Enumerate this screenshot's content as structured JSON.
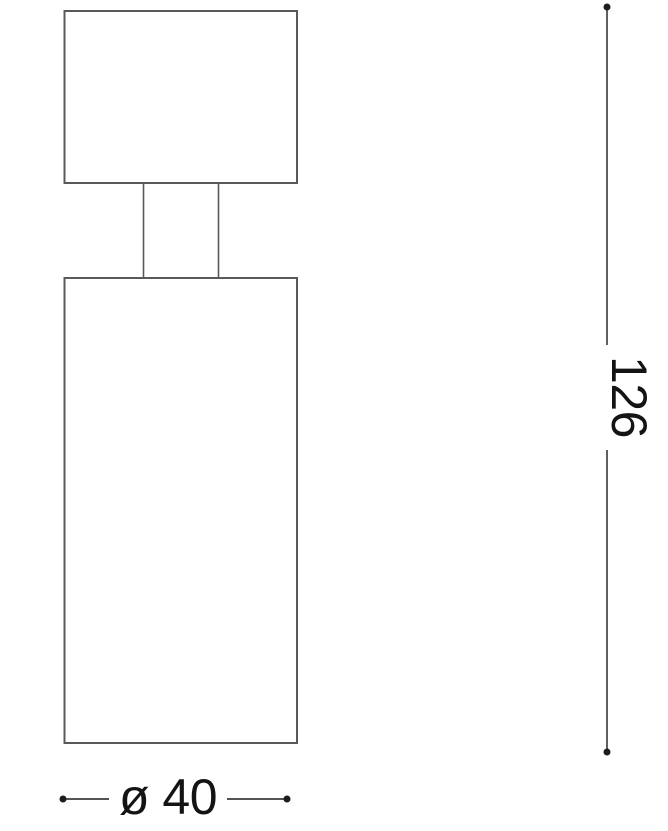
{
  "drawing": {
    "title": "Ceiling spotlight technical dimension drawing",
    "labels": {
      "height": "126",
      "diameter": "ø 40"
    },
    "colors": {
      "outline": "#595959",
      "dimension": "#1c1c1c",
      "text": "#141414",
      "background": "#ffffff"
    }
  }
}
